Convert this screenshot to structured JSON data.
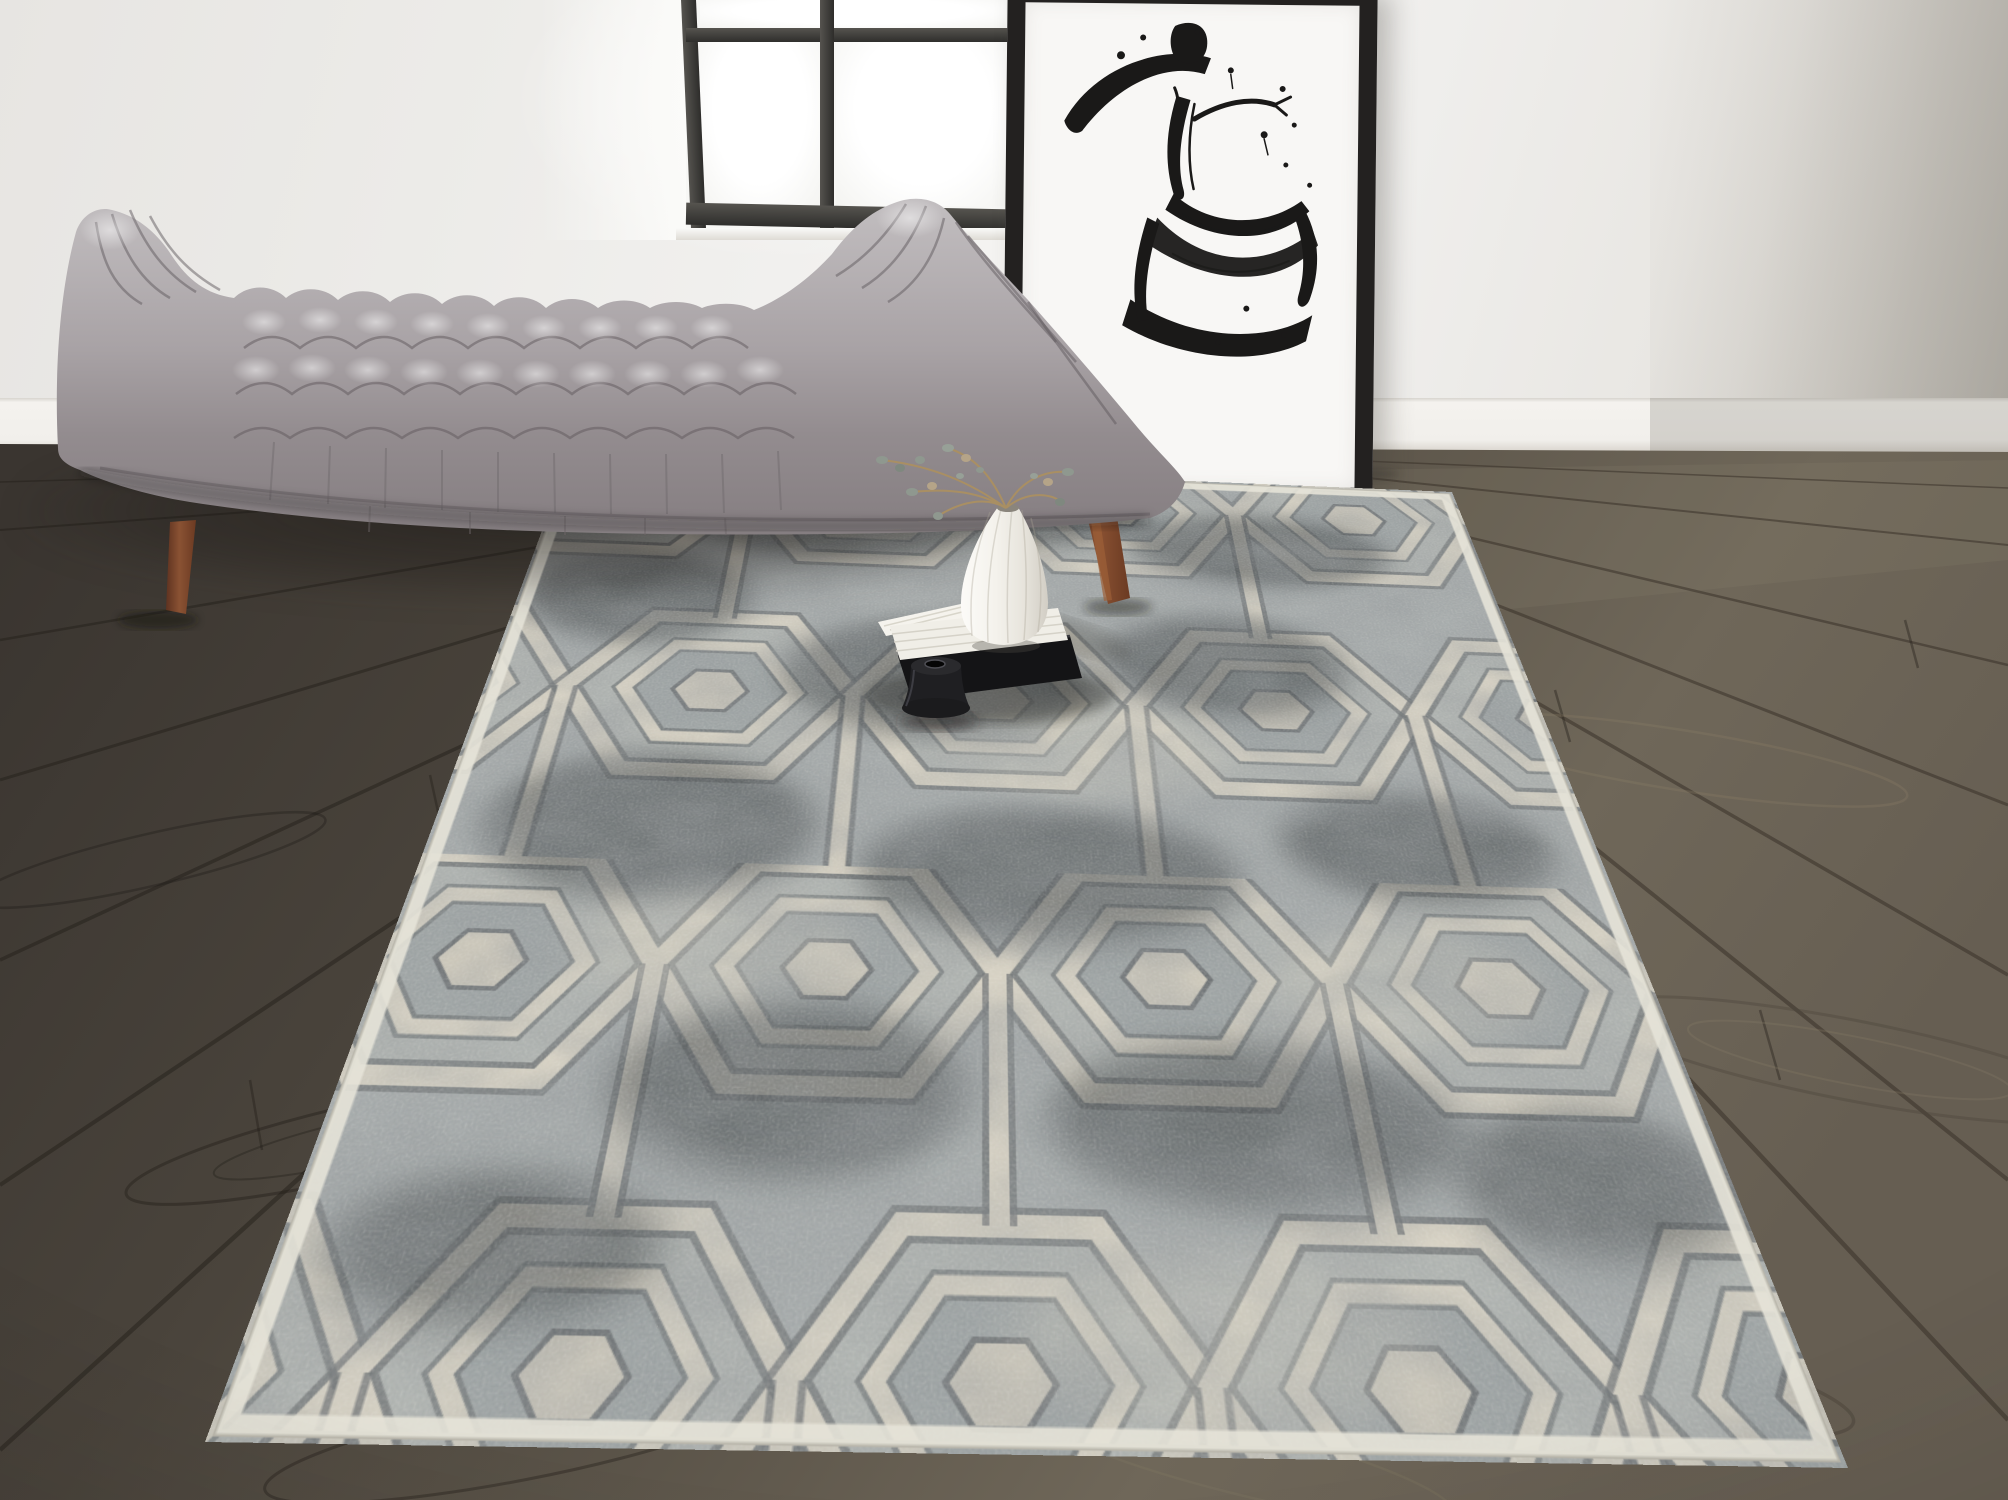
{
  "scene": {
    "type": "interior product photograph of a hexagon-pattern area rug in a living room",
    "room": {
      "wall_color": "#edecea",
      "baseboard_color": "#f2f0ec",
      "floor": {
        "label": "dark gray-brown wood plank floor",
        "base_colors": [
          "#3e3933",
          "#6f6759"
        ],
        "seam_color": "#241f1a"
      }
    },
    "window": {
      "label": "black-framed window with bright daylight",
      "frame_color": "#454442",
      "glass_color": "#fcfcfb",
      "visible_panes": 4
    },
    "artwork": {
      "label": "leaning black-framed ink sketch of a woman in a wide-brimmed hat",
      "frame_color": "#232120",
      "canvas_color": "#f8f7f5",
      "ink_color": "#1a1918"
    },
    "bench": {
      "label": "gray biscuit-tufted upholstered bench with curved arms",
      "fabric_colors": [
        "#c2bec0",
        "#a39da0",
        "#8d8689"
      ],
      "leg_color": "#6b3a22",
      "legs_visible": 2
    },
    "rug": {
      "label": "distressed gray and ivory hexagon trellis area rug",
      "pattern": "concentric hexagon lattice with vertical links",
      "colors": {
        "ivory": "#d6d1c3",
        "gray": "#a7acac",
        "charcoal": "#3f4447",
        "binding": "#e6e3d8"
      }
    },
    "still_life": {
      "vase": {
        "label": "white fluted teardrop vase",
        "color": "#f3f1ec"
      },
      "stems": {
        "label": "dried sprigs with small gray-green leaves",
        "stem_color": "#a98f63",
        "leaf_color": "#8f988f"
      },
      "white_book": {
        "label": "white book with splayed pages",
        "color": "#f0eee7"
      },
      "black_book": {
        "label": "black book",
        "color": "#141416"
      },
      "candleholder": {
        "label": "small black candle holder",
        "color": "#1f1f22"
      }
    },
    "lighting": {
      "window_light": "soft daylight from upper center",
      "right_wall_shadow": "#b5b1a8"
    }
  }
}
